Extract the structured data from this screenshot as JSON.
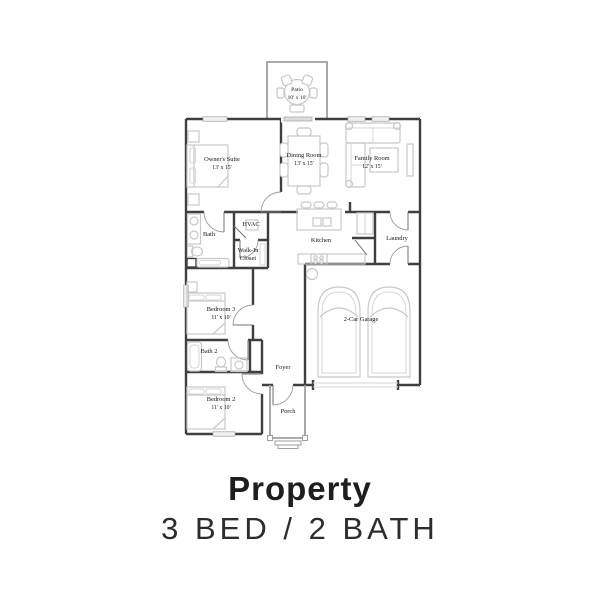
{
  "footer": {
    "title": "Property",
    "subtitle": "3 BED / 2 BATH"
  },
  "colors": {
    "wall": "#3f3f3f",
    "furniture": "#c8c8c8",
    "light_structure": "#9e9e9e",
    "label_text": "#161616",
    "footer_text": "#1e1e1e",
    "background": "#ffffff"
  },
  "rooms": {
    "patio": {
      "name": "Patio",
      "dims": "10' x 10'"
    },
    "owners_suite": {
      "name": "Owner's Suite",
      "dims": "13' x 15'"
    },
    "dining_room": {
      "name": "Dining Room",
      "dims": "13' x 15'"
    },
    "family_room": {
      "name": "Family Room",
      "dims": "12' x 15'"
    },
    "bath": {
      "name": "Bath"
    },
    "hvac": {
      "name": "HVAC"
    },
    "walk_in_closet": {
      "name_line1": "Walk-In",
      "name_line2": "Closet"
    },
    "kitchen": {
      "name": "Kitchen"
    },
    "laundry": {
      "name": "Laundry"
    },
    "bedroom3": {
      "name": "Bedroom 3",
      "dims": "11' x 10'"
    },
    "bath2": {
      "name": "Bath 2"
    },
    "foyer": {
      "name": "Foyer"
    },
    "bedroom2": {
      "name": "Bedroom 2",
      "dims": "11' x 10'"
    },
    "porch": {
      "name": "Porch"
    },
    "garage": {
      "name": "2-Car Garage"
    }
  }
}
